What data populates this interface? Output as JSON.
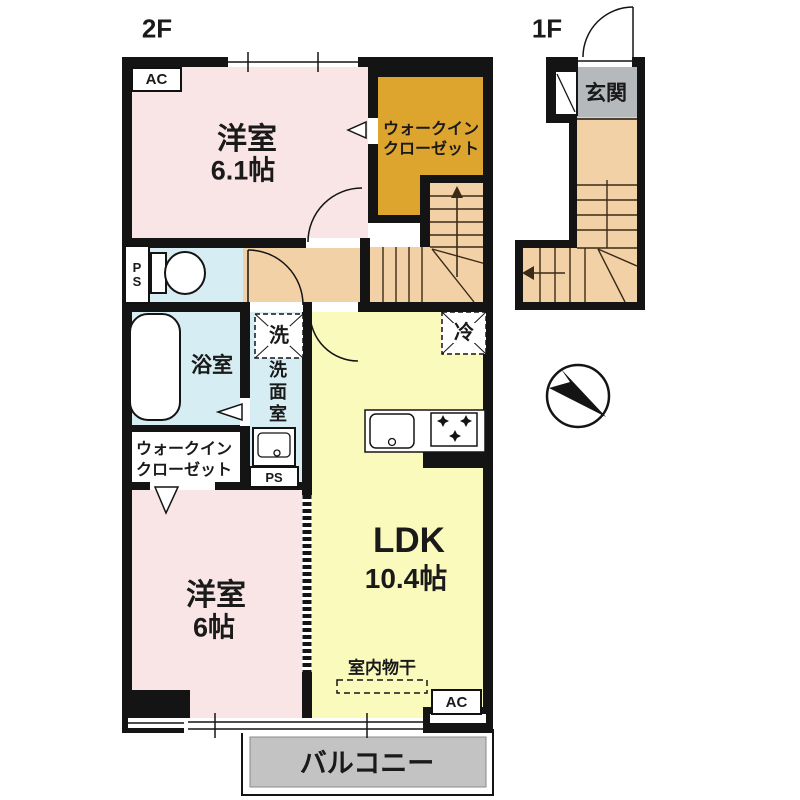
{
  "colors": {
    "bedroom_pink": "#f9e5e5",
    "closet_orange": "#dda42e",
    "wet_area_blue": "#d5edf3",
    "hall_stairs_peach": "#f3d1a7",
    "ldk_yellow": "#fafabc",
    "entrance_gray": "#b5b9bb",
    "balcony_gray": "#c3c3c3",
    "wall_black": "#141414"
  },
  "floor2": {
    "label": "2F",
    "ac_label": "AC",
    "ps_label": "PS",
    "bedroom1": {
      "name": "洋室",
      "size": "6.1帖"
    },
    "wic1": {
      "line1": "ウォークイン",
      "line2": "クローゼット"
    },
    "bathroom": {
      "name": "浴室"
    },
    "washroom": {
      "name": "洗面室",
      "washer": "洗"
    },
    "wic2": {
      "line1": "ウォークイン",
      "line2": "クローゼット"
    },
    "ldk": {
      "name": "LDK",
      "size": "10.4帖",
      "fridge": "冷",
      "drying": "室内物干"
    },
    "bedroom2": {
      "name": "洋室",
      "size": "6帖"
    },
    "balcony": {
      "name": "バルコニー"
    }
  },
  "floor1": {
    "label": "1F",
    "entrance": {
      "name": "玄関"
    }
  }
}
